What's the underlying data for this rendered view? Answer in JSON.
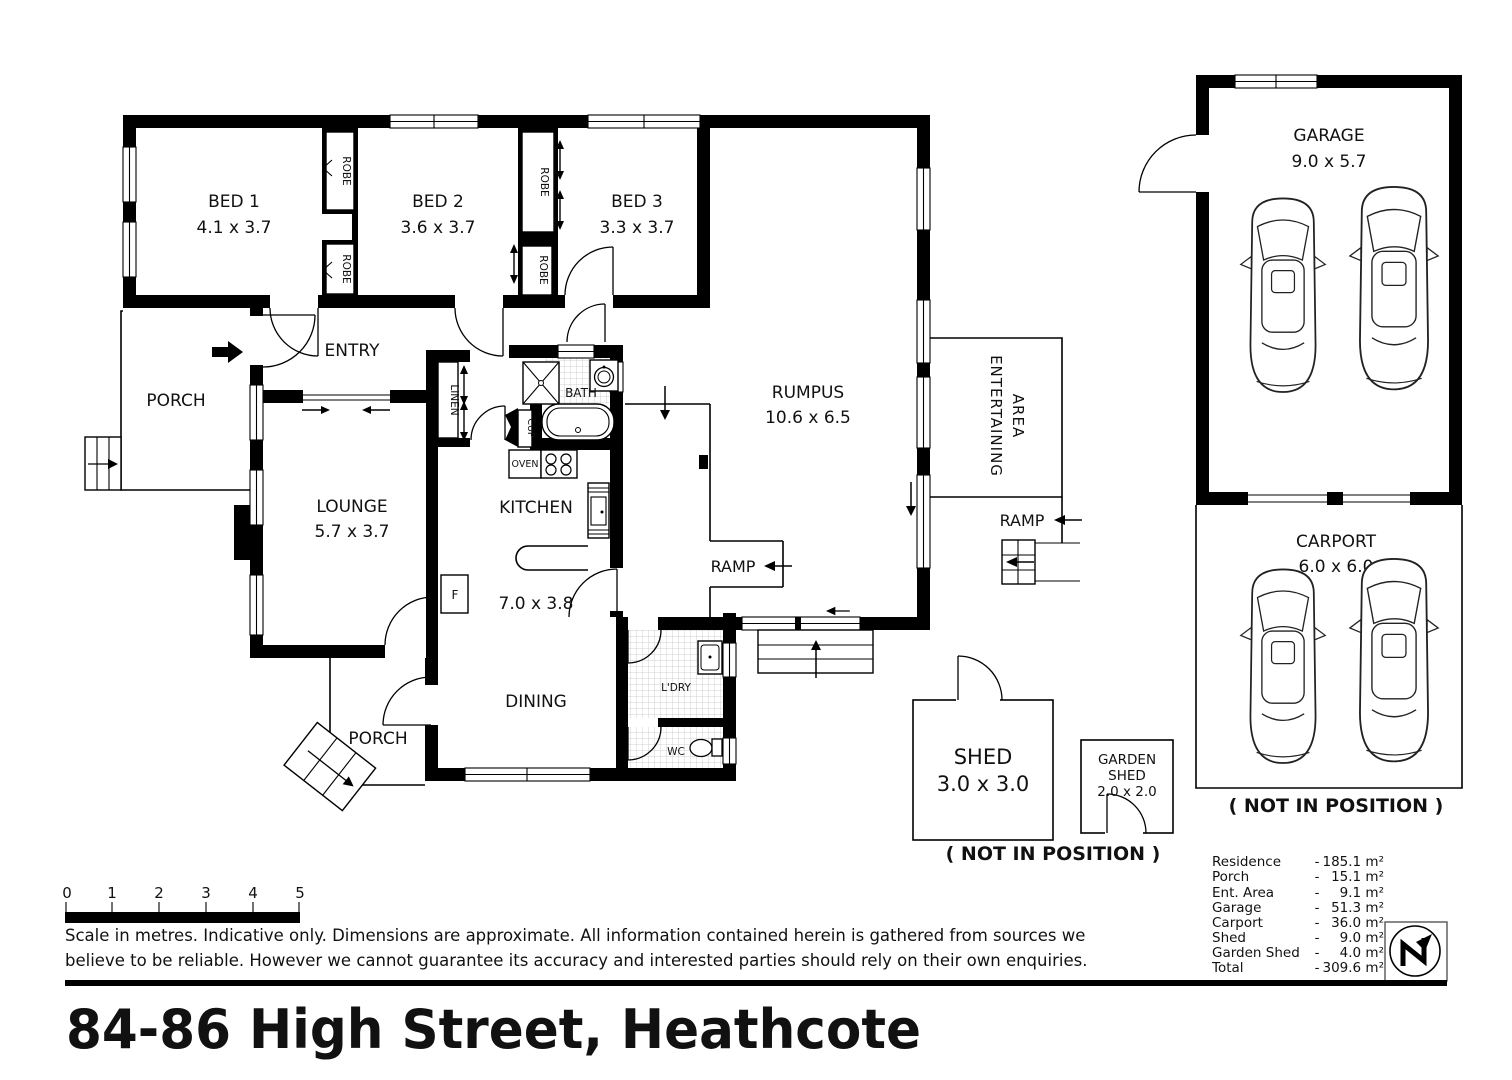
{
  "title": "84-86 High Street, Heathcote",
  "plan": {
    "rooms": {
      "bed1": {
        "name": "BED 1",
        "dims": "4.1 x 3.7"
      },
      "bed2": {
        "name": "BED 2",
        "dims": "3.6 x 3.7"
      },
      "bed3": {
        "name": "BED 3",
        "dims": "3.3 x 3.7"
      },
      "entry": {
        "name": "ENTRY"
      },
      "porch_front": {
        "name": "PORCH"
      },
      "lounge": {
        "name": "LOUNGE",
        "dims": "5.7 x 3.7"
      },
      "kitchen": {
        "name": "KITCHEN",
        "dims": "7.0 x 3.8"
      },
      "bath": {
        "name": "BATH"
      },
      "rumpus": {
        "name": "RUMPUS",
        "dims": "10.6 x 6.5"
      },
      "entertaining": {
        "line1": "ENTERTAINING",
        "line2": "AREA"
      },
      "dining": {
        "name": "DINING"
      },
      "laundry": {
        "name": "L'DRY"
      },
      "wc": {
        "name": "WC"
      },
      "porch_rear": {
        "name": "PORCH"
      }
    },
    "fixtures": {
      "robe": "ROBE",
      "linen": "LINEN",
      "cupboard": "CUP",
      "oven": "OVEN",
      "fridge": "F"
    },
    "ramp_label": "RAMP",
    "outbuildings": {
      "garage": {
        "name": "GARAGE",
        "dims": "9.0 x 5.7"
      },
      "carport": {
        "name": "CARPORT",
        "dims": "6.0 x 6.0"
      },
      "shed": {
        "name": "SHED",
        "dims": "3.0 x 3.0"
      },
      "garden_shed": {
        "line1": "GARDEN",
        "line2": "SHED",
        "dims": "2.0 x 2.0"
      }
    },
    "not_in_position": "( NOT IN POSITION )"
  },
  "scale_bar": {
    "ticks": [
      "0",
      "1",
      "2",
      "3",
      "4",
      "5"
    ]
  },
  "disclaimer": {
    "line1": "Scale in metres. Indicative only. Dimensions are approximate. All information contained herein is gathered from sources we",
    "line2": "believe to be reliable. However we cannot guarantee  its accuracy and interested parties should rely on their own enquiries."
  },
  "areas": {
    "separator": "-",
    "rows": [
      {
        "label": "Residence",
        "value": "185.1 m²"
      },
      {
        "label": "Porch",
        "value": "15.1 m²"
      },
      {
        "label": "Ent. Area",
        "value": "9.1 m²"
      },
      {
        "label": "Garage",
        "value": "51.3 m²"
      },
      {
        "label": "Carport",
        "value": "36.0 m²"
      },
      {
        "label": "Shed",
        "value": "9.0 m²"
      },
      {
        "label": "Garden Shed",
        "value": "4.0 m²"
      },
      {
        "label": "Total",
        "value": "309.6 m²"
      }
    ]
  },
  "colors": {
    "ink": "#000000",
    "paper": "#ffffff",
    "tile": "#c4c4c4"
  }
}
